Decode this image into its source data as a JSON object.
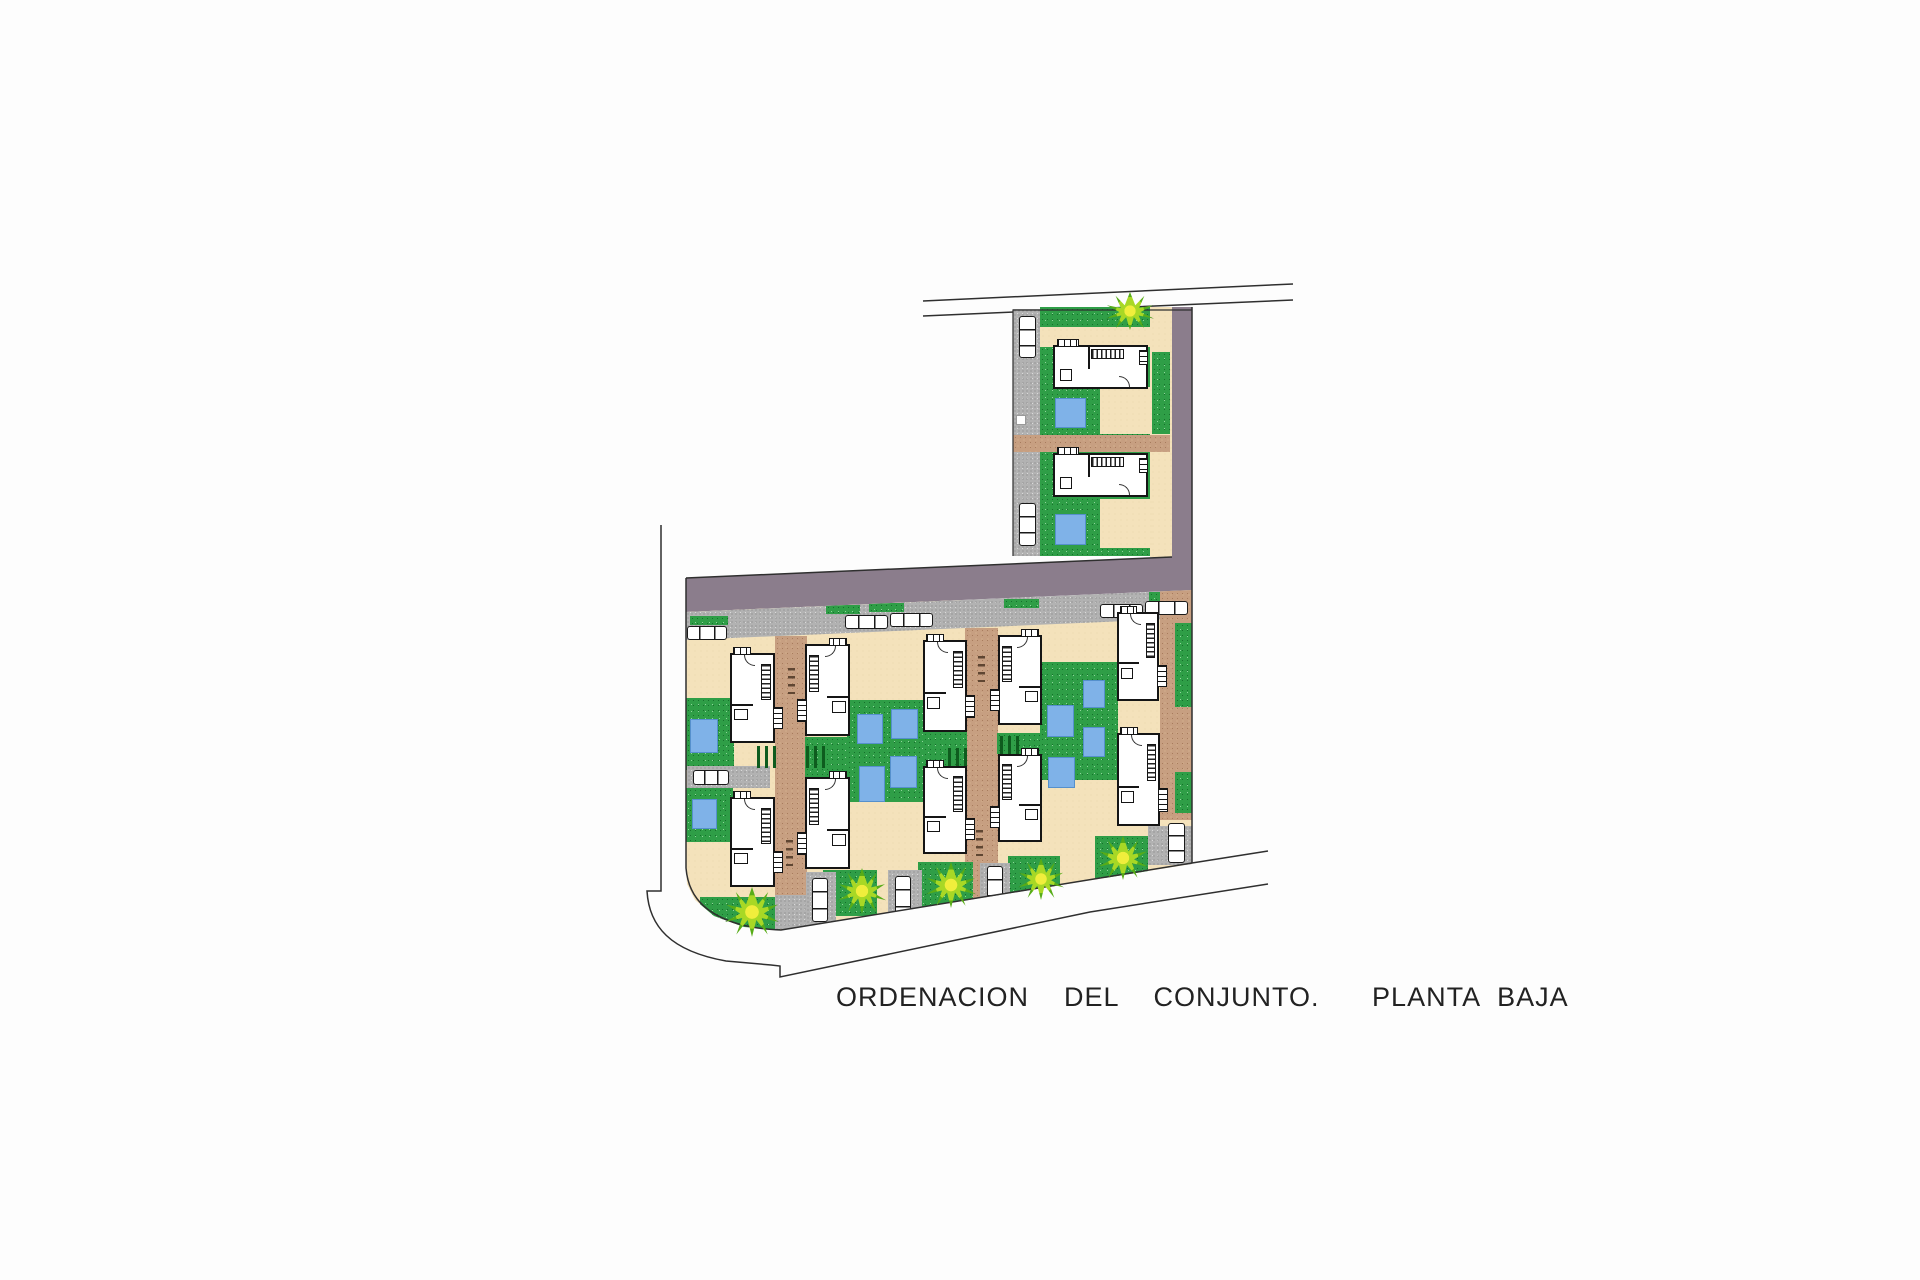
{
  "title": {
    "text": "ORDENACION  DEL  CONJUNTO.   PLANTA BAJA"
  },
  "colors": {
    "road_asphalt": "#8b7d8c",
    "lawn_green": "#2f9e47",
    "lot_cream": "#f4e2bb",
    "driveway_tan": "#c79f81",
    "pavement_gray": "#b2b2b2",
    "pool_blue": "#7fb2e8",
    "line_dark": "#2f2f2f",
    "palm_yellow": "#f0ee3c",
    "palm_green": "#2e7d12"
  },
  "outlines": {
    "purple_road": "M686,578 L1172,557 L1172,307 L1192,307 L1192,590 L686,612 Z",
    "road_upper_line": "M923,301 L1293,284",
    "road_lower_line": "M923,316 L1293,300",
    "street_curb_left": "M661,525 L661,891 L647,891 C649,926 670,951 726,961 L771,965 L780,966 L780,977 L1090,912 L1268,884",
    "block_outline": "M686,578 L686,868 C688,892 700,909 727,920 C744,927 762,929 781,930 L1192,863 L1268,851",
    "road_top_edge": "M686,578 L1172,557",
    "block_right_edge": "M1192,307 L1192,863",
    "upper_block_edge": "M1192,310 L1013,310 L1013,556"
  },
  "shapes": [
    {
      "l": "tr",
      "t": "green",
      "x": 1040,
      "y": 307,
      "w": 132,
      "h": 249
    },
    {
      "l": "tr",
      "t": "gray",
      "x": 1013,
      "y": 309,
      "w": 27,
      "h": 247
    },
    {
      "l": "tr",
      "t": "tan",
      "x": 1040,
      "y": 327,
      "w": 130,
      "h": 20
    },
    {
      "l": "tr",
      "t": "tan",
      "x": 1150,
      "y": 307,
      "w": 22,
      "h": 250
    },
    {
      "l": "tr",
      "t": "green",
      "x": 1152,
      "y": 352,
      "w": 18,
      "h": 82
    },
    {
      "l": "tr",
      "t": "tan",
      "x": 1100,
      "y": 387,
      "w": 52,
      "h": 47
    },
    {
      "l": "tr",
      "t": "drive",
      "x": 1013,
      "y": 435,
      "w": 157,
      "h": 17
    },
    {
      "l": "tr",
      "t": "tan",
      "x": 1100,
      "y": 499,
      "w": 52,
      "h": 49
    },
    {
      "l": "tr",
      "t": "pool",
      "x": 1055,
      "y": 398,
      "w": 31,
      "h": 30
    },
    {
      "l": "tr",
      "t": "pool",
      "x": 1055,
      "y": 514,
      "w": 31,
      "h": 31
    },
    {
      "l": "tr",
      "t": "white",
      "x": 1016,
      "y": 415,
      "w": 10,
      "h": 10
    },
    {
      "l": "tr",
      "t": "house-h",
      "x": 1053,
      "y": 345,
      "w": 95,
      "h": 44
    },
    {
      "l": "tr",
      "t": "house-h",
      "x": 1053,
      "y": 453,
      "w": 95,
      "h": 44
    },
    {
      "l": "tr",
      "t": "car-v",
      "x": 1019,
      "y": 316,
      "w": 17,
      "h": 42
    },
    {
      "l": "tr",
      "t": "car-v",
      "x": 1019,
      "y": 503,
      "w": 17,
      "h": 43
    },
    {
      "l": "main",
      "t": "tan",
      "x": 686,
      "y": 600,
      "w": 506,
      "h": 332
    },
    {
      "l": "main",
      "t": "gray-band",
      "x": 686,
      "y": 588,
      "w": 506,
      "h": 52
    },
    {
      "l": "main",
      "t": "green",
      "x": 690,
      "y": 616,
      "w": 38,
      "h": 9
    },
    {
      "l": "main",
      "t": "green",
      "x": 826,
      "y": 605,
      "w": 34,
      "h": 9
    },
    {
      "l": "main",
      "t": "green",
      "x": 869,
      "y": 603,
      "w": 35,
      "h": 9
    },
    {
      "l": "main",
      "t": "green",
      "x": 1004,
      "y": 599,
      "w": 35,
      "h": 9
    },
    {
      "l": "main",
      "t": "green",
      "x": 1149,
      "y": 592,
      "w": 36,
      "h": 9
    },
    {
      "l": "main",
      "t": "drive",
      "x": 775,
      "y": 636,
      "w": 32,
      "h": 296
    },
    {
      "l": "main",
      "t": "drive",
      "x": 965,
      "y": 628,
      "w": 33,
      "h": 277
    },
    {
      "l": "main",
      "t": "drive",
      "x": 1160,
      "y": 566,
      "w": 32,
      "h": 254
    },
    {
      "l": "main",
      "t": "green",
      "x": 686,
      "y": 698,
      "w": 48,
      "h": 72
    },
    {
      "l": "main",
      "t": "green",
      "x": 683,
      "y": 788,
      "w": 50,
      "h": 54
    },
    {
      "l": "main",
      "t": "green",
      "x": 700,
      "y": 897,
      "w": 80,
      "h": 33
    },
    {
      "l": "main",
      "t": "green",
      "x": 805,
      "y": 737,
      "w": 46,
      "h": 41
    },
    {
      "l": "main",
      "t": "green",
      "x": 847,
      "y": 700,
      "w": 77,
      "h": 102
    },
    {
      "l": "main",
      "t": "green",
      "x": 923,
      "y": 732,
      "w": 44,
      "h": 37
    },
    {
      "l": "main",
      "t": "green",
      "x": 997,
      "y": 733,
      "w": 43,
      "h": 21
    },
    {
      "l": "main",
      "t": "green",
      "x": 1040,
      "y": 662,
      "w": 78,
      "h": 118
    },
    {
      "l": "main",
      "t": "green",
      "x": 1175,
      "y": 623,
      "w": 17,
      "h": 84
    },
    {
      "l": "main",
      "t": "green",
      "x": 1175,
      "y": 772,
      "w": 17,
      "h": 41
    },
    {
      "l": "main",
      "t": "green",
      "x": 823,
      "y": 870,
      "w": 54,
      "h": 46
    },
    {
      "l": "main",
      "t": "green",
      "x": 918,
      "y": 862,
      "w": 55,
      "h": 46
    },
    {
      "l": "main",
      "t": "green",
      "x": 1008,
      "y": 856,
      "w": 52,
      "h": 44
    },
    {
      "l": "main",
      "t": "green",
      "x": 1095,
      "y": 836,
      "w": 53,
      "h": 42
    },
    {
      "l": "main",
      "t": "gray",
      "x": 687,
      "y": 766,
      "w": 83,
      "h": 22
    },
    {
      "l": "main",
      "t": "gray",
      "x": 775,
      "y": 895,
      "w": 32,
      "h": 34
    },
    {
      "l": "main",
      "t": "gray",
      "x": 806,
      "y": 872,
      "w": 30,
      "h": 54
    },
    {
      "l": "main",
      "t": "gray",
      "x": 888,
      "y": 870,
      "w": 34,
      "h": 56
    },
    {
      "l": "main",
      "t": "gray",
      "x": 980,
      "y": 863,
      "w": 30,
      "h": 48
    },
    {
      "l": "main",
      "t": "gray",
      "x": 1148,
      "y": 826,
      "w": 45,
      "h": 39
    },
    {
      "l": "main",
      "t": "pool",
      "x": 690,
      "y": 719,
      "w": 28,
      "h": 34
    },
    {
      "l": "main",
      "t": "pool",
      "x": 692,
      "y": 799,
      "w": 25,
      "h": 30
    },
    {
      "l": "main",
      "t": "pool",
      "x": 857,
      "y": 714,
      "w": 26,
      "h": 30
    },
    {
      "l": "main",
      "t": "pool",
      "x": 891,
      "y": 709,
      "w": 27,
      "h": 30
    },
    {
      "l": "main",
      "t": "pool",
      "x": 859,
      "y": 766,
      "w": 26,
      "h": 36
    },
    {
      "l": "main",
      "t": "pool",
      "x": 890,
      "y": 756,
      "w": 27,
      "h": 32
    },
    {
      "l": "main",
      "t": "pool",
      "x": 1047,
      "y": 705,
      "w": 27,
      "h": 32
    },
    {
      "l": "main",
      "t": "pool",
      "x": 1048,
      "y": 757,
      "w": 27,
      "h": 31
    },
    {
      "l": "main",
      "t": "pool",
      "x": 1083,
      "y": 680,
      "w": 22,
      "h": 28
    },
    {
      "l": "main",
      "t": "pool",
      "x": 1083,
      "y": 727,
      "w": 22,
      "h": 30
    },
    {
      "l": "main",
      "t": "car-h",
      "x": 687,
      "y": 626,
      "w": 40,
      "h": 14
    },
    {
      "l": "main",
      "t": "car-h",
      "x": 845,
      "y": 615,
      "w": 43,
      "h": 14
    },
    {
      "l": "main",
      "t": "car-h",
      "x": 890,
      "y": 613,
      "w": 43,
      "h": 14
    },
    {
      "l": "main",
      "t": "car-h",
      "x": 1100,
      "y": 604,
      "w": 43,
      "h": 14
    },
    {
      "l": "main",
      "t": "car-h",
      "x": 1145,
      "y": 601,
      "w": 43,
      "h": 14
    },
    {
      "l": "main",
      "t": "car-h",
      "x": 693,
      "y": 770,
      "w": 36,
      "h": 15
    },
    {
      "l": "main",
      "t": "car-v",
      "x": 812,
      "y": 878,
      "w": 16,
      "h": 44
    },
    {
      "l": "main",
      "t": "car-v",
      "x": 895,
      "y": 876,
      "w": 16,
      "h": 44
    },
    {
      "l": "main",
      "t": "car-v",
      "x": 987,
      "y": 866,
      "w": 16,
      "h": 42
    },
    {
      "l": "main",
      "t": "car-v",
      "x": 1168,
      "y": 823,
      "w": 17,
      "h": 40
    },
    {
      "l": "main",
      "t": "shrubs",
      "x": 757,
      "y": 746,
      "w": 20,
      "h": 22
    },
    {
      "l": "main",
      "t": "shrubs",
      "x": 806,
      "y": 746,
      "w": 20,
      "h": 22
    },
    {
      "l": "main",
      "t": "shrubs",
      "x": 948,
      "y": 748,
      "w": 20,
      "h": 22
    },
    {
      "l": "main",
      "t": "shrubs",
      "x": 1000,
      "y": 736,
      "w": 20,
      "h": 18
    },
    {
      "l": "main",
      "t": "ticks",
      "x": 788,
      "y": 668,
      "w": 7,
      "h": 26
    },
    {
      "l": "main",
      "t": "ticks",
      "x": 786,
      "y": 840,
      "w": 7,
      "h": 26
    },
    {
      "l": "main",
      "t": "ticks",
      "x": 978,
      "y": 656,
      "w": 7,
      "h": 26
    },
    {
      "l": "main",
      "t": "ticks",
      "x": 976,
      "y": 830,
      "w": 7,
      "h": 26
    },
    {
      "l": "main",
      "t": "house-v",
      "x": 730,
      "y": 653,
      "w": 45,
      "h": 90
    },
    {
      "l": "main",
      "t": "house-v",
      "x": 805,
      "y": 644,
      "w": 45,
      "h": 92,
      "f": 1
    },
    {
      "l": "main",
      "t": "house-v",
      "x": 923,
      "y": 640,
      "w": 44,
      "h": 92
    },
    {
      "l": "main",
      "t": "house-v",
      "x": 998,
      "y": 635,
      "w": 44,
      "h": 90,
      "f": 1
    },
    {
      "l": "main",
      "t": "house-v",
      "x": 1117,
      "y": 612,
      "w": 42,
      "h": 89
    },
    {
      "l": "main",
      "t": "house-v",
      "x": 730,
      "y": 797,
      "w": 45,
      "h": 90
    },
    {
      "l": "main",
      "t": "house-v",
      "x": 805,
      "y": 777,
      "w": 45,
      "h": 92,
      "f": 1
    },
    {
      "l": "main",
      "t": "house-v",
      "x": 923,
      "y": 766,
      "w": 44,
      "h": 88
    },
    {
      "l": "main",
      "t": "house-v",
      "x": 998,
      "y": 754,
      "w": 44,
      "h": 88,
      "f": 1
    },
    {
      "l": "main",
      "t": "house-v",
      "x": 1117,
      "y": 733,
      "w": 43,
      "h": 93
    },
    {
      "l": "decor",
      "t": "palm",
      "x": 725,
      "y": 887,
      "w": 54,
      "h": 50
    },
    {
      "l": "decor",
      "t": "palm",
      "x": 838,
      "y": 868,
      "w": 48,
      "h": 46
    },
    {
      "l": "decor",
      "t": "palm",
      "x": 926,
      "y": 862,
      "w": 50,
      "h": 46
    },
    {
      "l": "decor",
      "t": "palm",
      "x": 1018,
      "y": 858,
      "w": 46,
      "h": 42
    },
    {
      "l": "decor",
      "t": "palm",
      "x": 1098,
      "y": 836,
      "w": 50,
      "h": 44
    },
    {
      "l": "decor",
      "t": "palm",
      "x": 1106,
      "y": 292,
      "w": 48,
      "h": 38
    }
  ]
}
